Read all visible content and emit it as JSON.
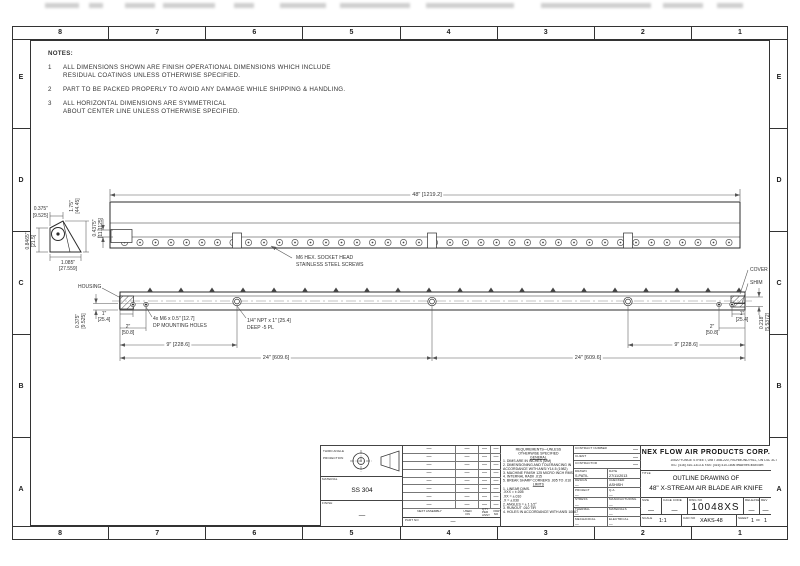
{
  "zones": {
    "columns": [
      "8",
      "7",
      "6",
      "5",
      "4",
      "3",
      "2",
      "1"
    ],
    "rows": [
      "E",
      "D",
      "C",
      "B",
      "A"
    ]
  },
  "notes": {
    "title": "NOTES:",
    "items": [
      {
        "num": "1",
        "lines": [
          "ALL DIMENSIONS SHOWN ARE FINISH OPERATIONAL DIMENSIONS WHICH INCLUDE",
          "RESIDUAL COATINGS UNLESS OTHERWISE SPECIFIED."
        ]
      },
      {
        "num": "2",
        "lines": [
          "PART TO BE PACKED PROPERLY TO AVOID ANY DAMAGE WHILE SHIPPING & HANDLING."
        ]
      },
      {
        "num": "3",
        "lines": [
          "ALL HORIZONTAL DIMENSIONS ARE SYMMETRICAL",
          "ABOUT CENTER LINE UNLESS OTHERWISE SPECIFIED."
        ]
      }
    ]
  },
  "top_view": {
    "dim_overall": "48\" [1219.2]",
    "dim_height": [
      "0.4375\"",
      "[11.1125]"
    ],
    "screw_label": [
      "M6 HEX. SOCKET HEAD",
      "STAINLESS STEEL SCREWS"
    ]
  },
  "profile_view": {
    "dim_top": [
      "0.375\"",
      "[9.525]"
    ],
    "dim_right": [
      "1.75\"",
      "[44.45]"
    ],
    "dim_left": [
      "0.8465\"",
      "[21.5]"
    ],
    "dim_bottom": [
      "1.085\"",
      "[27.559]"
    ]
  },
  "front_view": {
    "housing": "HOUSING",
    "cover": "COVER",
    "shim": "SHIM",
    "dim_lip": [
      "0.375\"",
      "[9.525]"
    ],
    "dim_1_left": [
      "1\"",
      "[25.4]"
    ],
    "dim_2_left": [
      "2\"",
      "[50.8]"
    ],
    "dim_9_left": "9\" [228.6]",
    "dim_24_left": "24\" [609.6]",
    "dim_24_right": "24\" [609.6]",
    "dim_9_right": "9\" [228.6]",
    "dim_2_right": [
      "2\"",
      "[50.8]"
    ],
    "dim_1_right": [
      "1\"",
      "[25.4]"
    ],
    "dim_gap": [
      "0.218\"",
      "[5.5372]"
    ],
    "mounting_label": [
      "4x M6 x 0.5\" [12.7]",
      "DP MOUNTING HOLES"
    ],
    "npt_label": [
      "1/4\" NPT x 1\" [25.4]",
      "DEEP -5 PL"
    ]
  },
  "title_block": {
    "projection_label": [
      "THIRD ANGLE",
      "PROJECTION"
    ],
    "material_label": "MATERIAL",
    "material": "SS 304",
    "finish_label": "FINISH",
    "finish": "—",
    "parts_table": {
      "headers": [
        "NEXT ASSEMBLY",
        "USED ON",
        "QTY PER ASSY",
        "PART NO"
      ],
      "rows": [
        [
          "—",
          "—",
          "—",
          "—"
        ],
        [
          "—",
          "—",
          "—",
          "—"
        ],
        [
          "—",
          "—",
          "—",
          "—"
        ],
        [
          "—",
          "—",
          "—",
          "—"
        ],
        [
          "—",
          "—",
          "—",
          "—"
        ],
        [
          "—",
          "—",
          "—",
          "—"
        ],
        [
          "—",
          "—",
          "—",
          "—"
        ],
        [
          "—",
          "—",
          "—",
          "—"
        ]
      ],
      "part_no_label": "PART NO",
      "part_no": "—"
    },
    "requirements": {
      "lines": [
        {
          "t": "REQUIREMENTS—UNLESS",
          "c": 1
        },
        {
          "t": "OTHERWISE SPECIFIED",
          "c": 1
        },
        {
          "t": "GENERAL",
          "c": 1,
          "u": 1
        },
        {
          "t": "1. DIMS ARE IN INCHES (MM)"
        },
        {
          "t": "2. DIMENSIONING AND TOLERANCING IN"
        },
        {
          "t": "    ACCORDANCE WITH ANSI Y14.5 (1982)"
        },
        {
          "t": "3. MACHINE FINISH 125 MICRO INCH RMS."
        },
        {
          "t": "4. INTERNAL RADII .015"
        },
        {
          "t": "5. BREAK SHARP CORNERS .005 TO .010"
        },
        {
          "t": "LIMITS",
          "c": 1,
          "u": 1
        },
        {
          "t": "1. LINEAR DIMS."
        },
        {
          "t": "    .XXX = ±.005"
        },
        {
          "t": "    .XX = ±.010"
        },
        {
          "t": "    .X = ±.030"
        },
        {
          "t": "2. ANGLES = ± 1 1/2°"
        },
        {
          "t": "3. RUNOUT .010 TIR"
        },
        {
          "t": "4. HOLES IN ACCORDANCE WITH ANSI 10087"
        }
      ]
    },
    "admin": {
      "top_fields": [
        {
          "label": "CONTRACT NUMBER",
          "value": "—"
        },
        {
          "label": "CLIENT",
          "value": "—"
        },
        {
          "label": "CONTRACTOR",
          "value": "—"
        }
      ],
      "rows": [
        {
          "l": "DRAWN",
          "lv": "S.PATIL",
          "r": "DATE",
          "rv": "27/11/2013"
        },
        {
          "l": "DESIGN",
          "lv": "—",
          "r": "CHECKED",
          "rv": "ASHISH"
        },
        {
          "l": "PROJECT",
          "lv": "—",
          "r": "Q.A.",
          "rv": "—"
        },
        {
          "l": "STRESS",
          "lv": "—",
          "r": "MANUFACTURING",
          "rv": "—"
        },
        {
          "l": "THERMAL",
          "lv": "—",
          "r": "MATERIALS",
          "rv": "—"
        },
        {
          "l": "MECHANICAL",
          "lv": "—",
          "r": "ELECTRICAL",
          "rv": "—"
        }
      ]
    },
    "company": {
      "name": "NEX FLOW AIR PRODUCTS CORP.",
      "address": "10520 YONGE STREET, UNIT 35B-220, RICHMOND HILL, ON L4C 3C7",
      "tel": "TEL: (416) 410-1313 & FAX: (416) 410-1806  www.nex-flow.com",
      "title_label": "TITLE",
      "title_line1": "OUTLINE DRAWING OF",
      "title_line2": "48\" X-STREAM AIR BLADE AIR KNIFE"
    },
    "fields": {
      "size_label": "SIZE",
      "size": "—",
      "cage_label": "CAGE CODE",
      "cage": "—",
      "dwg_label": "DWG NO",
      "dwg_no": "10048XS",
      "release_label": "RELEASE",
      "release": "—",
      "rev_label": "REV",
      "rev": "—",
      "scale_label": "SCALE",
      "scale": "1:1",
      "cad_label": "CAD NO",
      "cad_no": "XAKS-48",
      "sheet_label": "SHEET",
      "sheet": "1",
      "of_label": "OF",
      "sheet_total": "1"
    }
  }
}
